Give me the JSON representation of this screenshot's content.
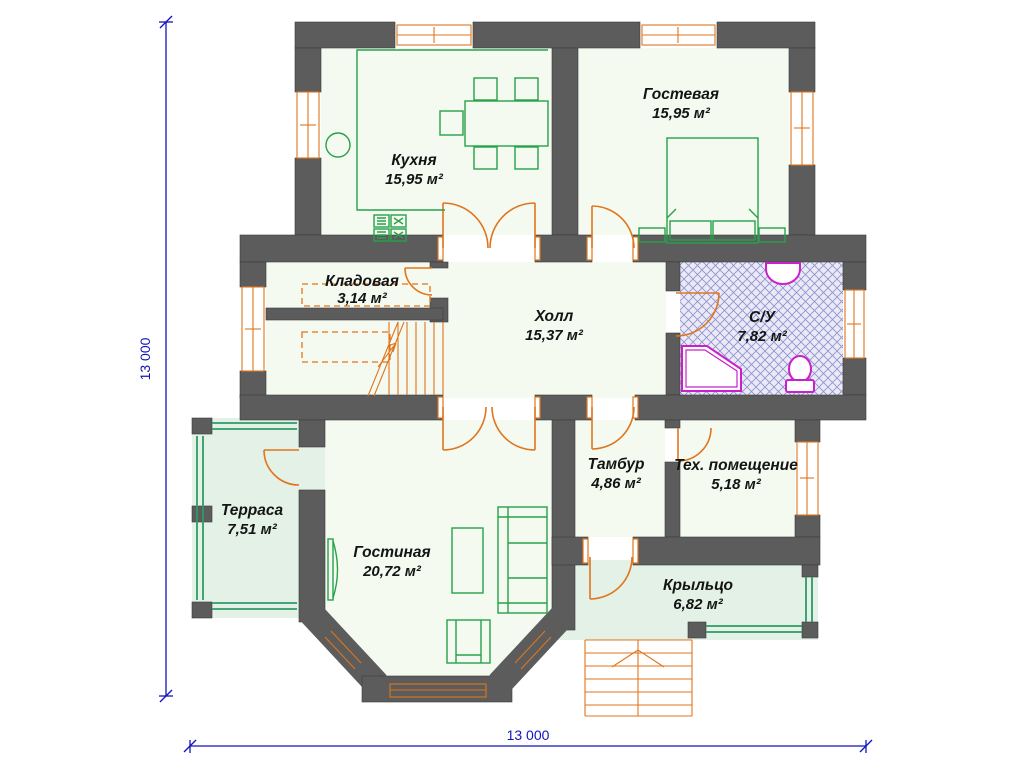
{
  "plan": {
    "rooms": [
      {
        "id": "kitchen",
        "name": "Кухня",
        "area": "15,95 м²"
      },
      {
        "id": "guest",
        "name": "Гостевая",
        "area": "15,95 м²"
      },
      {
        "id": "storage",
        "name": "Кладовая",
        "area": "3,14 м²"
      },
      {
        "id": "hall",
        "name": "Холл",
        "area": "15,37 м²"
      },
      {
        "id": "bathroom",
        "name": "С/У",
        "area": "7,82 м²"
      },
      {
        "id": "terrace",
        "name": "Терраса",
        "area": "7,51 м²"
      },
      {
        "id": "living",
        "name": "Гостиная",
        "area": "20,72 м²"
      },
      {
        "id": "vestibule",
        "name": "Тамбур",
        "area": "4,86 м²"
      },
      {
        "id": "tech",
        "name": "Тех. помещение",
        "area": "5,18 м²"
      },
      {
        "id": "porch",
        "name": "Крыльцо",
        "area": "6,82 м²"
      }
    ],
    "dimensions": {
      "height_label": "13 000",
      "width_label": "13 000"
    },
    "colors": {
      "wall": "#5c5c5c",
      "door_window": "#e0751c",
      "furniture": "#27a24a",
      "railing": "#2d9b66",
      "sanitary": "#cb1fcb",
      "dimension": "#1313bd",
      "hatch": "#8f8fcf",
      "room_fill": "#f5faf1",
      "outdoor_fill": "#e4f1e6"
    }
  }
}
